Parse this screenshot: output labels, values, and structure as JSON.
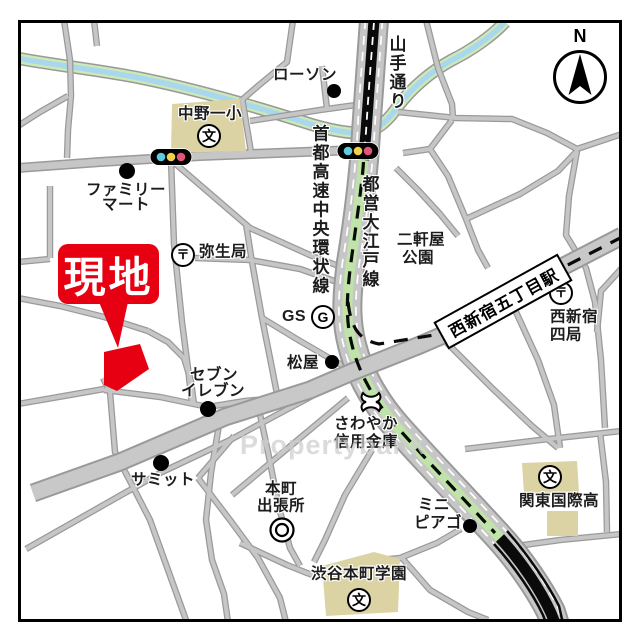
{
  "map": {
    "callout": {
      "label": "現地"
    },
    "station_sign": {
      "label": "西新宿五丁目駅"
    },
    "watermark": "Propertybank",
    "compass": {
      "label": "N"
    },
    "colors": {
      "site_red": "#e60012",
      "road_fill": "#c6c6c6",
      "road_edge": "#999999",
      "river_blue": "#a9d7ee",
      "river_green": "#cde9b4",
      "subway_green": "#bfe3a8",
      "building_beige": "#dcd3a4",
      "signal_blue": "#5fcbe3",
      "signal_yellow": "#efd24c",
      "signal_red": "#e05578"
    },
    "labels": [
      {
        "id": "lawson",
        "text": "ローソン",
        "x": 305,
        "y": 75
      },
      {
        "id": "yamate-dori",
        "text": "山手通り",
        "x": 396,
        "y": 73,
        "vertical": true,
        "size": 17
      },
      {
        "id": "nakano-daiichi",
        "text": "中野一小",
        "x": 210,
        "y": 114
      },
      {
        "id": "familymart-1",
        "text": "ファミリー",
        "x": 126,
        "y": 190
      },
      {
        "id": "familymart-2",
        "text": "マート",
        "x": 126,
        "y": 205
      },
      {
        "id": "shuto-expressway",
        "text": "首都高速中央環状線",
        "x": 319,
        "y": 210,
        "vertical": true,
        "size": 17
      },
      {
        "id": "toei-oedo-line",
        "text": "都営大江戸線",
        "x": 369,
        "y": 232,
        "vertical": true,
        "size": 17
      },
      {
        "id": "nikenya-park-1",
        "text": "二軒屋",
        "x": 421,
        "y": 240
      },
      {
        "id": "nikenya-park-2",
        "text": "公園",
        "x": 418,
        "y": 258
      },
      {
        "id": "yayoi-post",
        "text": "弥生局",
        "x": 223,
        "y": 252
      },
      {
        "id": "gs",
        "text": "GS",
        "x": 294,
        "y": 317,
        "size": 16
      },
      {
        "id": "nishishinjuku-1",
        "text": "西新宿",
        "x": 574,
        "y": 317
      },
      {
        "id": "nishishinjuku-2",
        "text": "四局",
        "x": 566,
        "y": 335
      },
      {
        "id": "matsuya",
        "text": "松屋",
        "x": 303,
        "y": 363
      },
      {
        "id": "seven-1",
        "text": "セブン",
        "x": 214,
        "y": 375
      },
      {
        "id": "seven-2",
        "text": "イレブン",
        "x": 213,
        "y": 391
      },
      {
        "id": "sawayaka-1",
        "text": "さわやか",
        "x": 366,
        "y": 424
      },
      {
        "id": "sawayaka-2",
        "text": "信用金庫",
        "x": 366,
        "y": 442
      },
      {
        "id": "summit",
        "text": "サミット",
        "x": 163,
        "y": 480
      },
      {
        "id": "honmachi-1",
        "text": "本町",
        "x": 281,
        "y": 489
      },
      {
        "id": "honmachi-2",
        "text": "出張所",
        "x": 281,
        "y": 506
      },
      {
        "id": "mini-piago-1",
        "text": "ミニ",
        "x": 434,
        "y": 505
      },
      {
        "id": "mini-piago-2",
        "text": "ピアゴ",
        "x": 438,
        "y": 523
      },
      {
        "id": "kanto-kokusai",
        "text": "関東国際高",
        "x": 559,
        "y": 501
      },
      {
        "id": "shibuya-honmachi",
        "text": "渋谷本町学園",
        "x": 359,
        "y": 574
      }
    ],
    "icons": [
      {
        "name": "lawson-dot",
        "type": "dot",
        "x": 334,
        "y": 91,
        "r": 7
      },
      {
        "name": "familymart-dot",
        "type": "dot",
        "x": 127,
        "y": 171,
        "r": 8
      },
      {
        "name": "matsuya-dot",
        "type": "dot",
        "x": 332,
        "y": 362,
        "r": 7
      },
      {
        "name": "seven-eleven-dot",
        "type": "dot",
        "x": 208,
        "y": 409,
        "r": 8
      },
      {
        "name": "summit-dot",
        "type": "dot",
        "x": 161,
        "y": 463,
        "r": 8
      },
      {
        "name": "mini-piago-dot",
        "type": "dot",
        "x": 470,
        "y": 526,
        "r": 7
      },
      {
        "name": "traffic-light-west",
        "type": "traffic",
        "x": 171,
        "y": 157
      },
      {
        "name": "traffic-light-east",
        "type": "traffic",
        "x": 358,
        "y": 151
      },
      {
        "name": "yayoi-post-mark",
        "type": "post",
        "x": 183,
        "y": 255,
        "glyph": "〒"
      },
      {
        "name": "nishishinjuku-post-mark",
        "type": "post",
        "x": 561,
        "y": 293,
        "glyph": "〒"
      },
      {
        "name": "nakano-school-mark",
        "type": "school",
        "x": 209,
        "y": 136,
        "glyph": "文"
      },
      {
        "name": "kanto-school-mark",
        "type": "school",
        "x": 550,
        "y": 477,
        "glyph": "文"
      },
      {
        "name": "shibuya-school-mark",
        "type": "school",
        "x": 359,
        "y": 600,
        "glyph": "文"
      },
      {
        "name": "honmachi-office-mark",
        "type": "gov",
        "x": 282,
        "y": 530
      },
      {
        "name": "gas-station-mark",
        "type": "gas",
        "x": 323,
        "y": 317,
        "glyph": "G"
      },
      {
        "name": "bank-mark",
        "type": "bank",
        "x": 371,
        "y": 402
      }
    ]
  }
}
